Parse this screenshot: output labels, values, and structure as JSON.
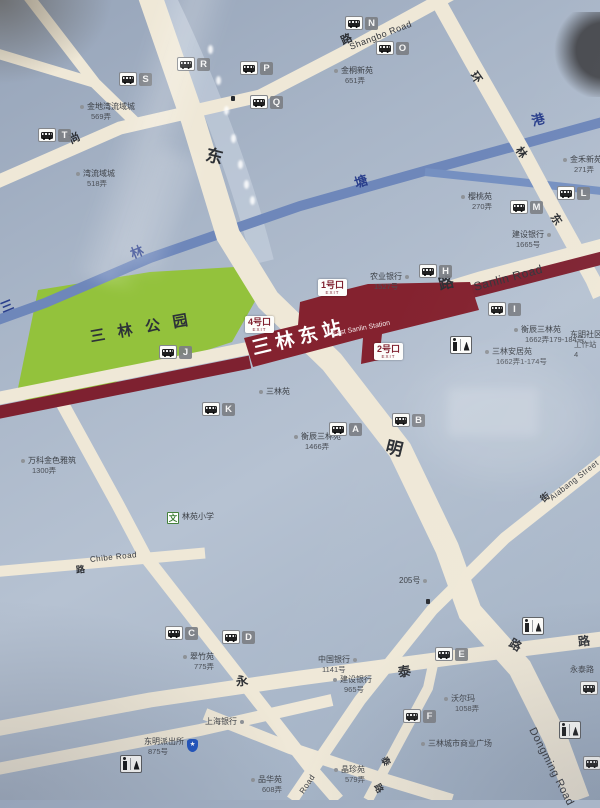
{
  "map_type": "station-area-street-map-photo",
  "station": {
    "name": "三林东站",
    "name_en": "East Sanlin Station"
  },
  "park": {
    "name": "三林公园"
  },
  "exits": [
    {
      "label": "1号口",
      "caption": "EXIT",
      "x": 318,
      "y": 279
    },
    {
      "label": "2号口",
      "caption": "EXIT",
      "x": 374,
      "y": 343
    },
    {
      "label": "4号口",
      "caption": "EXIT",
      "x": 245,
      "y": 316
    }
  ],
  "river_labels": [
    {
      "ch": "三",
      "x": 1,
      "y": 302,
      "rot": -22
    },
    {
      "ch": "林",
      "x": 131,
      "y": 248,
      "rot": -22
    },
    {
      "ch": "塘",
      "x": 355,
      "y": 177,
      "rot": -18
    },
    {
      "ch": "港",
      "x": 532,
      "y": 115,
      "rot": -16
    }
  ],
  "road_labels": [
    {
      "text": "东",
      "x": 206,
      "y": 146,
      "rot": 14,
      "size": 17
    },
    {
      "text": "明",
      "x": 386,
      "y": 438,
      "rot": 14,
      "size": 17
    },
    {
      "text": "路",
      "x": 510,
      "y": 636,
      "rot": 30,
      "size": 12
    },
    {
      "text": "Dongming Road",
      "x": 531,
      "y": 723,
      "rot": 63,
      "size": 11,
      "en": true
    },
    {
      "text": "尚",
      "x": 70,
      "y": 136,
      "rot": -24,
      "size": 11
    },
    {
      "text": "路",
      "x": 342,
      "y": 37,
      "rot": -24,
      "size": 11
    },
    {
      "text": "Shangbo Road",
      "x": 350,
      "y": 43,
      "rot": -21,
      "size": 9,
      "en": true
    },
    {
      "text": "环",
      "x": 472,
      "y": 68,
      "rot": 55,
      "size": 11
    },
    {
      "text": "林",
      "x": 517,
      "y": 143,
      "rot": 55,
      "size": 11
    },
    {
      "text": "东",
      "x": 552,
      "y": 210,
      "rot": 55,
      "size": 11
    },
    {
      "text": "路",
      "x": 439,
      "y": 278,
      "rot": -15,
      "size": 15
    },
    {
      "text": "Sanlin Road",
      "x": 474,
      "y": 281,
      "rot": -15,
      "size": 12,
      "en": true
    },
    {
      "text": "路",
      "x": 76,
      "y": 566,
      "rot": -6,
      "size": 9
    },
    {
      "text": "Chibe Road",
      "x": 90,
      "y": 556,
      "rot": -6,
      "size": 8,
      "en": true
    },
    {
      "text": "街",
      "x": 542,
      "y": 496,
      "rot": -38,
      "size": 9
    },
    {
      "text": "Aiabang Street",
      "x": 551,
      "y": 495,
      "rot": -38,
      "size": 8,
      "en": true
    },
    {
      "text": "永",
      "x": 236,
      "y": 676,
      "rot": -9,
      "size": 12
    },
    {
      "text": "泰",
      "x": 398,
      "y": 666,
      "rot": -9,
      "size": 13
    },
    {
      "text": "路",
      "x": 578,
      "y": 636,
      "rot": -7,
      "size": 12
    },
    {
      "text": "泰",
      "x": 383,
      "y": 753,
      "rot": 62,
      "size": 9
    },
    {
      "text": "路",
      "x": 376,
      "y": 780,
      "rot": 62,
      "size": 9
    },
    {
      "text": "Road",
      "x": 302,
      "y": 789,
      "rot": -56,
      "size": 8,
      "en": true
    }
  ],
  "bus_stops": [
    {
      "letter": "T",
      "x": 47,
      "y": 135
    },
    {
      "letter": "S",
      "x": 128,
      "y": 79
    },
    {
      "letter": "R",
      "x": 186,
      "y": 64
    },
    {
      "letter": "P",
      "x": 249,
      "y": 68
    },
    {
      "letter": "Q",
      "x": 259,
      "y": 102
    },
    {
      "letter": "N",
      "x": 354,
      "y": 23
    },
    {
      "letter": "O",
      "x": 385,
      "y": 48
    },
    {
      "letter": "M",
      "x": 519,
      "y": 207
    },
    {
      "letter": "L",
      "x": 566,
      "y": 193
    },
    {
      "letter": "H",
      "x": 428,
      "y": 271
    },
    {
      "letter": "I",
      "x": 497,
      "y": 309
    },
    {
      "letter": "J",
      "x": 168,
      "y": 352
    },
    {
      "letter": "K",
      "x": 211,
      "y": 409
    },
    {
      "letter": "A",
      "x": 338,
      "y": 429
    },
    {
      "letter": "B",
      "x": 401,
      "y": 420
    },
    {
      "letter": "C",
      "x": 174,
      "y": 633
    },
    {
      "letter": "D",
      "x": 231,
      "y": 637
    },
    {
      "letter": "E",
      "x": 444,
      "y": 654
    },
    {
      "letter": "F",
      "x": 412,
      "y": 716
    },
    {
      "letter": "",
      "x": 589,
      "y": 688
    },
    {
      "letter": "",
      "x": 592,
      "y": 763
    }
  ],
  "pois": [
    {
      "name": "金地湾流域城",
      "sub": "569弄",
      "x": 80,
      "y": 102,
      "dot": "left"
    },
    {
      "name": "湾流域城",
      "sub": "518弄",
      "x": 76,
      "y": 169,
      "dot": "left"
    },
    {
      "name": "金桐新苑",
      "sub": "651弄",
      "x": 334,
      "y": 66,
      "dot": "left"
    },
    {
      "name": "金禾新苑",
      "sub": "271弄",
      "x": 563,
      "y": 155,
      "dot": "left"
    },
    {
      "name": "樱桃苑",
      "sub": "270弄",
      "x": 461,
      "y": 192,
      "dot": "left"
    },
    {
      "name": "建设银行",
      "sub": "1665号",
      "x": 512,
      "y": 230,
      "dot": "right"
    },
    {
      "name": "农业银行",
      "sub": "1527号",
      "x": 370,
      "y": 272,
      "dot": "right"
    },
    {
      "name": "三林苑",
      "sub": "",
      "x": 259,
      "y": 387,
      "dot": "left"
    },
    {
      "name": "衡辰三林苑",
      "sub": "1662弄179-184号",
      "x": 514,
      "y": 325,
      "dot": "left"
    },
    {
      "name": "三林安居苑",
      "sub": "1662弄1-174号",
      "x": 485,
      "y": 347,
      "dot": "left"
    },
    {
      "name": "东明社区",
      "sub": "工作站",
      "sub2": "4",
      "x": 570,
      "y": 330,
      "dot": "none"
    },
    {
      "name": "衡辰三林苑",
      "sub": "1466弄",
      "x": 294,
      "y": 432,
      "dot": "left"
    },
    {
      "name": "万科金色雅筑",
      "sub": "1300弄",
      "x": 21,
      "y": 456,
      "dot": "left"
    },
    {
      "name": "205号",
      "sub": "",
      "x": 399,
      "y": 576,
      "dot": "right"
    },
    {
      "name": "翠竹苑",
      "sub": "775弄",
      "x": 183,
      "y": 652,
      "dot": "left"
    },
    {
      "name": "中国银行",
      "sub": "1141号",
      "x": 318,
      "y": 655,
      "dot": "right"
    },
    {
      "name": "建设银行",
      "sub": "965号",
      "x": 333,
      "y": 675,
      "dot": "left"
    },
    {
      "name": "沃尔玛",
      "sub": "1058弄",
      "x": 444,
      "y": 694,
      "dot": "left"
    },
    {
      "name": "上海银行",
      "sub": "",
      "x": 205,
      "y": 717,
      "dot": "right"
    },
    {
      "name": "三林城市商业广场",
      "sub": "",
      "x": 421,
      "y": 739,
      "dot": "left"
    },
    {
      "name": "永泰路",
      "sub": "",
      "x": 570,
      "y": 665,
      "dot": "none"
    },
    {
      "name": "东明派出所",
      "sub": "875号",
      "x": 144,
      "y": 737,
      "dot": "none",
      "icon": "police"
    },
    {
      "name": "品华苑",
      "sub": "608弄",
      "x": 251,
      "y": 775,
      "dot": "left"
    },
    {
      "name": "晶珍苑",
      "sub": "579弄",
      "x": 334,
      "y": 765,
      "dot": "left"
    },
    {
      "name": "林苑小学",
      "sub": "",
      "x": 167,
      "y": 512,
      "dot": "none",
      "icon": "school",
      "icon_glyph": "文"
    }
  ],
  "toilets": [
    {
      "x": 450,
      "y": 336
    },
    {
      "x": 522,
      "y": 617
    },
    {
      "x": 559,
      "y": 721
    },
    {
      "x": 120,
      "y": 755
    }
  ],
  "markers": [
    {
      "x": 231,
      "y": 96
    },
    {
      "x": 426,
      "y": 599
    }
  ],
  "colors": {
    "background": "#aab6c7",
    "road": "#efe8d7",
    "park_green": "#93c23c",
    "river_blue": "#6e87ba",
    "metro_maroon": "#7e2130",
    "station_fill": "#84222f",
    "badge_gray": "#7c7f84",
    "river_text": "#2a3f8c",
    "poi_text": "#3b3f45"
  }
}
